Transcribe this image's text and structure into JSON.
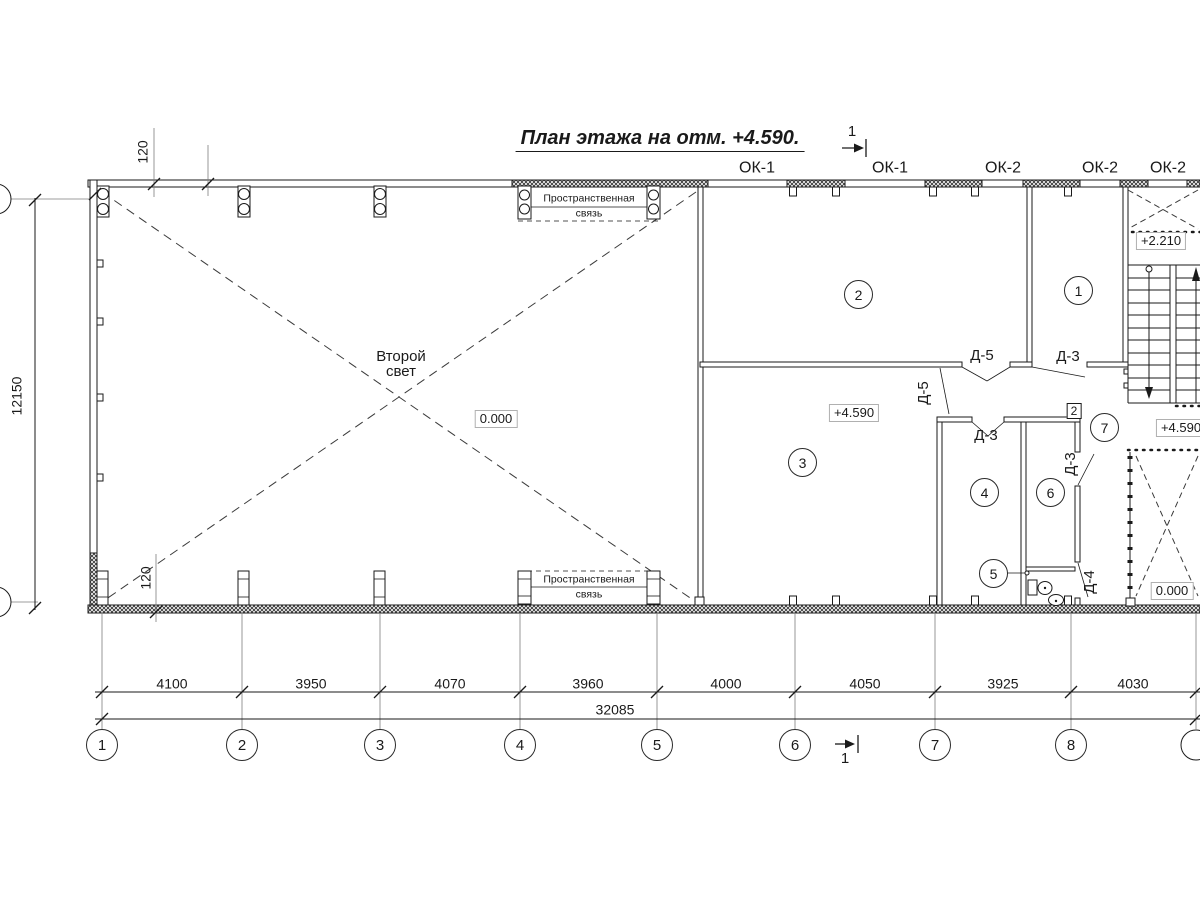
{
  "title": "План этажа на отм. +4.590.",
  "section_marks": {
    "top": "1",
    "bottom": "1"
  },
  "window_labels": [
    "ОК-1",
    "ОК-1",
    "ОК-2",
    "ОК-2",
    "ОК-2"
  ],
  "door_marks": {
    "d3": "Д-3",
    "d4": "Д-4",
    "d5": "Д-5"
  },
  "room_numbers": [
    "1",
    "2",
    "3",
    "4",
    "5",
    "6",
    "7"
  ],
  "node_mark": "2",
  "elevation_marks": {
    "hall": "0.000",
    "room3": "+4.590",
    "stair_landing": "+2.210",
    "corridor": "+4.590",
    "ground_floor": "0.000"
  },
  "annotations": {
    "second_light_line1": "Второй",
    "second_light_line2": "свет",
    "spatial_tie_line1": "Пространственная",
    "spatial_tie_line2": "связь"
  },
  "dimensions": {
    "spans": [
      "4100",
      "3950",
      "4070",
      "3960",
      "4000",
      "4050",
      "3925",
      "4030"
    ],
    "total": "32085",
    "height": "12150",
    "wall_offset_top": "120",
    "wall_offset_bottom": "120"
  },
  "axis_numbers": [
    "1",
    "2",
    "3",
    "4",
    "5",
    "6",
    "7",
    "8"
  ]
}
